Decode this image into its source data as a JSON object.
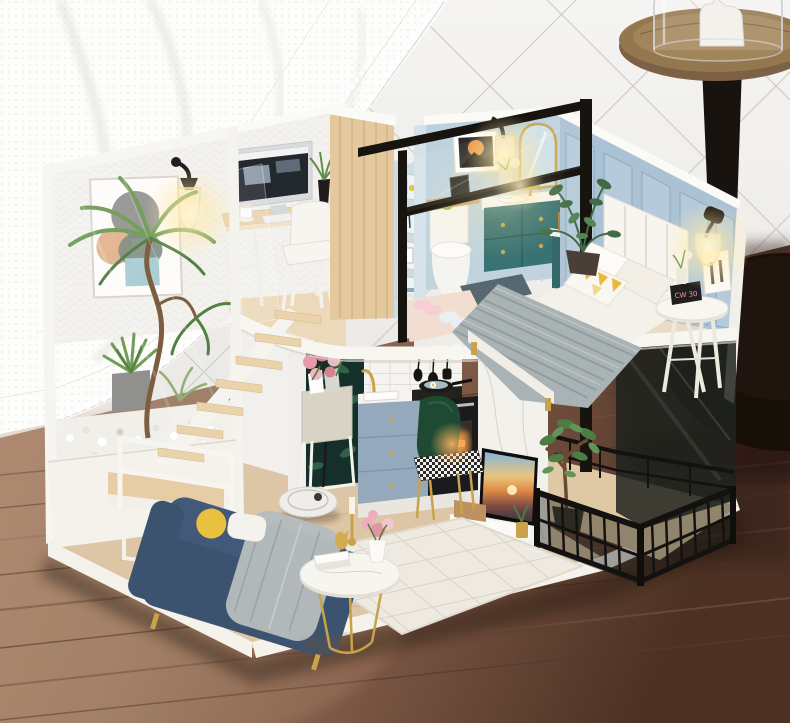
{
  "scene": {
    "subject": "Miniature DIY dollhouse diorama of a modern two-story loft apartment",
    "setting": "Dollhouse displayed on a wooden plank table in front of a white wall with thin diagonal diamond trim; a sheer white lace curtain drapes across the upper left and a round wooden pedestal display stand with a glass cloche stands behind at the upper right"
  },
  "background": {
    "wall": "white wall with diagonal diamond line pattern",
    "curtain": "sheer white lace curtain",
    "table": "brown wood plank tabletop, darker toward the right",
    "display_stand": [
      "round wooden tray top",
      "black tapered column",
      "black round base",
      "glass cloche with white figurine"
    ]
  },
  "house": {
    "upper_floor": {
      "loft_office": [
        "white patterned back wall",
        "abstract art poster",
        "black wall sconce with warm glowing bulb",
        "silver desktop computer",
        "white keyboard",
        "coffee cup",
        "black vase with green sprigs",
        "light wood trestle desk",
        "white chair",
        "clear acrylic guard panel"
      ],
      "wardrobe": [
        "light wood closet",
        "pale blue open shelf with books, pineapple figure and frames"
      ],
      "bathroom": [
        "light blue walls",
        "framed sunset art",
        "black wall sconce with glowing bulb",
        "white toilet with wood tray and tablet",
        "teal floating vanity with gold knobs and white counter",
        "gold arched mirror",
        "glass vase with flowers",
        "perfume bottles on low teal cabinet",
        "slate bath mat",
        "black-framed glass partition"
      ],
      "bedroom": {
        "items": [
          "blue paneled wall",
          "white channel-tufted headboard",
          "white bedding and pillows",
          "yellow triangle-pattern accent pillow",
          "gray knit throw draped over bed foot",
          "white round nightstand",
          "digital alarm clock",
          "white photo frame",
          "small white flowers",
          "black wall sconce with glowing bulb",
          "potted green plant",
          "pink slipper rug with two pairs of slippers"
        ],
        "clock_display": "CW 30"
      }
    },
    "lower_floor": {
      "kitchen": [
        "dark tropical-leaf wallpaper panel",
        "planter stand with pink roses and magazines",
        "white herringbone tile backsplash",
        "gold faucet and white sink",
        "blue-gray cabinets with gold knobs",
        "black cooktop with pan",
        "black oven with warm glow",
        "hanging black utensils",
        "thin black floor lamp"
      ],
      "living_room": [
        "navy blue sofa with gold legs",
        "gray throw blanket",
        "yellow round pillow",
        "white marble round coffee table with gold legs",
        "gold candlestick and deer figurine",
        "pink flowers in white vase",
        "white lattice rug",
        "white robot vacuum"
      ],
      "tv_area": [
        "white marble accent wall",
        "wall-mounted TV showing a sunset beach",
        "white media console",
        "wooden tissue box",
        "small gold plant pot"
      ],
      "balcony": [
        "light wood deck",
        "black metal railing with dark glass panels",
        "potted ficus tree"
      ],
      "atrium": [
        "glass-walled planter corner",
        "white pebbles",
        "gray cube planter with shrub",
        "tall curved-trunk plant",
        "floating light-wood staircase",
        "white landing with white railing"
      ]
    }
  },
  "palette": {
    "wallBg": "#f1efec",
    "wallLine": "#c7c4bf",
    "curtainWhite": "#fdfdfc",
    "tableWoodLight": "#ab8a70",
    "tableWoodDark": "#4b3023",
    "houseWhite": "#f6f4ef",
    "houseWallBlue": "#abc2d4",
    "houseWoodFloor": "#dcc6a6",
    "wardrobeWood": "#e4c99f",
    "vanityTeal": "#2e6b6b",
    "sofaNavy": "#3c536f",
    "blanketGray": "#a9b3b5",
    "kitchenBlue": "#95a9bd",
    "accentGold": "#c9a24b",
    "plantGreen": "#5f8f4a",
    "frameBlack": "#17140f",
    "glowWarm": "#ffeeb2",
    "rugWhite": "#efeae1"
  }
}
